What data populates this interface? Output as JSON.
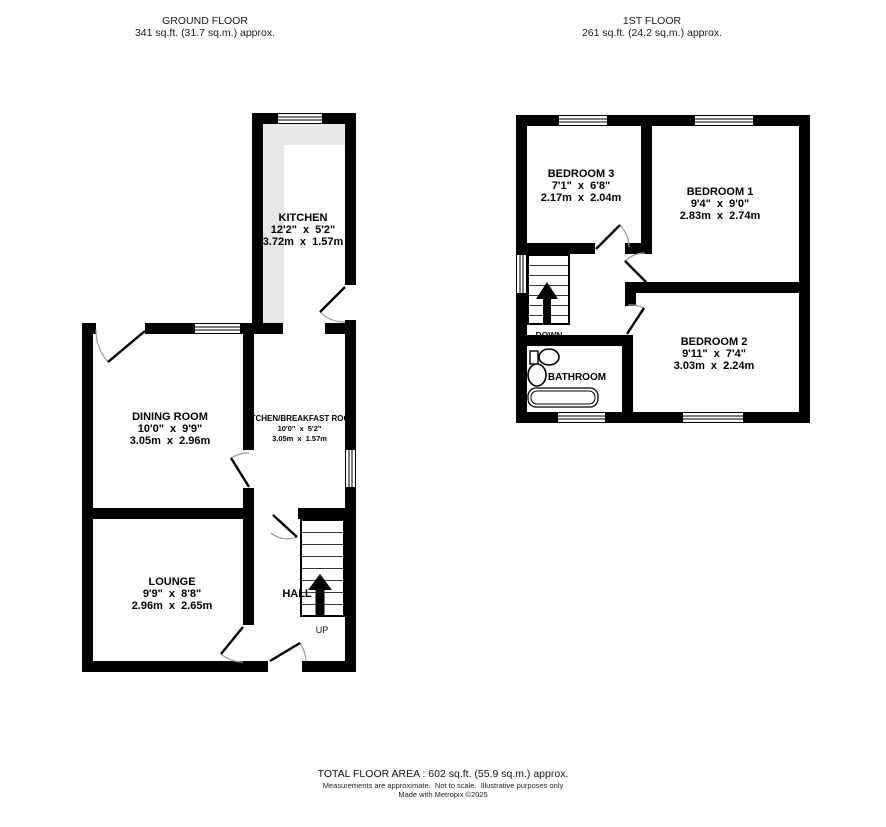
{
  "headers": {
    "ground": {
      "title": "GROUND FLOOR",
      "area": "341 sq.ft. (31.7 sq.m.) approx."
    },
    "first": {
      "title": "1ST FLOOR",
      "area": "261 sq.ft. (24.2 sq.m.) approx."
    }
  },
  "ground_floor": {
    "kitchen": {
      "name": "KITCHEN",
      "imperial": "12'2\" x 5'2\"",
      "metric": "3.72m x 1.57m"
    },
    "dining_room": {
      "name": "DINING ROOM",
      "imperial": "10'0\" x 9'9\"",
      "metric": "3.05m x 2.96m"
    },
    "kitchen_breakfast": {
      "name": "KITCHEN/BREAKFAST ROOM",
      "imperial": "10'0\" x 5'2\"",
      "metric": "3.05m x 1.57m"
    },
    "lounge": {
      "name": "LOUNGE",
      "imperial": "9'9\" x 8'8\"",
      "metric": "2.96m x 2.65m"
    },
    "hall": {
      "name": "HALL"
    },
    "stairs_label": "UP"
  },
  "first_floor": {
    "bedroom3": {
      "name": "BEDROOM 3",
      "imperial": "7'1\" x 6'8\"",
      "metric": "2.17m x 2.04m"
    },
    "bedroom1": {
      "name": "BEDROOM 1",
      "imperial": "9'4\" x 9'0\"",
      "metric": "2.83m x 2.74m"
    },
    "bedroom2": {
      "name": "BEDROOM 2",
      "imperial": "9'11\" x 7'4\"",
      "metric": "3.03m x 2.24m"
    },
    "bathroom": {
      "name": "BATHROOM"
    },
    "stairs_label": "DOWN"
  },
  "footer": {
    "total_area": "TOTAL FLOOR AREA : 602 sq.ft. (55.9 sq.m.) approx.",
    "disclaimer": "Measurements are approximate.  Not to scale.  Illustrative purposes only",
    "credit": "Made with Metropix ©2025"
  },
  "colors": {
    "wall": "#000000",
    "counter": "#e7e7e7"
  }
}
